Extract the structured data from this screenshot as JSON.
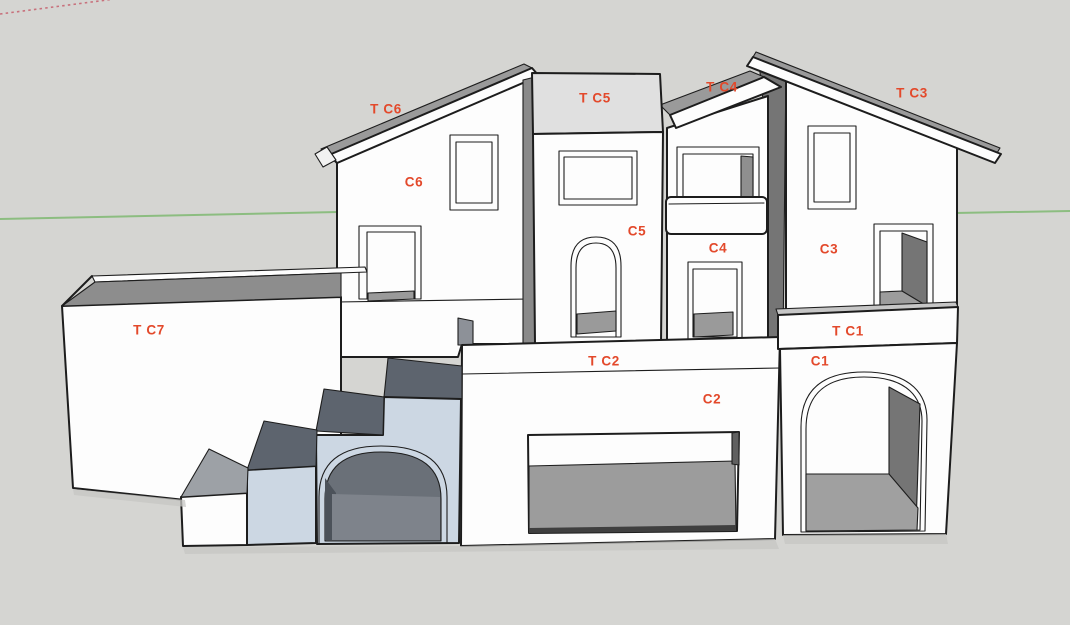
{
  "scene": {
    "description": "3D model viewport of a house facade with labeled faces",
    "background_color": "#d5d5d2",
    "label_color": "#e3492b",
    "green_axis_color": "#8cbd80",
    "red_axis_dashed_color": "#c8717c",
    "face_white": "#fdfdfd",
    "roof_gray": "#9a9a9a",
    "tower_top_gray": "#e0e0e0",
    "side_shadow_gray": "#757575",
    "stair_blue": "#ccd7e3",
    "stair_tread_dark": "#5d646e",
    "interior_dark": "#6a7078"
  },
  "labels": [
    {
      "id": "t-c6",
      "text": "T C6",
      "x": 386,
      "y": 109
    },
    {
      "id": "c6",
      "text": "C6",
      "x": 414,
      "y": 182
    },
    {
      "id": "t-c5",
      "text": "T C5",
      "x": 595,
      "y": 98
    },
    {
      "id": "c5",
      "text": "C5",
      "x": 637,
      "y": 231
    },
    {
      "id": "t-c4",
      "text": "T C4",
      "x": 722,
      "y": 87
    },
    {
      "id": "c4",
      "text": "C4",
      "x": 718,
      "y": 248
    },
    {
      "id": "t-c3",
      "text": "T C3",
      "x": 912,
      "y": 93
    },
    {
      "id": "c3",
      "text": "C3",
      "x": 829,
      "y": 249
    },
    {
      "id": "t-c7",
      "text": "T C7",
      "x": 149,
      "y": 330
    },
    {
      "id": "t-c2",
      "text": "T C2",
      "x": 604,
      "y": 361
    },
    {
      "id": "c2",
      "text": "C2",
      "x": 712,
      "y": 399
    },
    {
      "id": "t-c1",
      "text": "T C1",
      "x": 848,
      "y": 331
    },
    {
      "id": "c1",
      "text": "C1",
      "x": 820,
      "y": 361
    }
  ]
}
